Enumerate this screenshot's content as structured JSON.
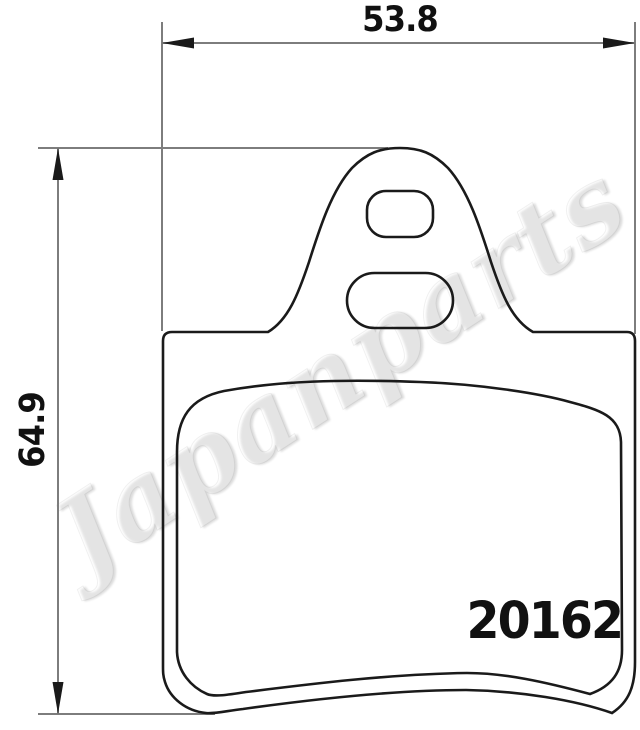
{
  "document": {
    "type": "technical-drawing",
    "subject": "brake-pad-outline"
  },
  "colors": {
    "background": "#ffffff",
    "outline": "#1a1a1a",
    "dimension": "#7d7d7d",
    "text": "#111111"
  },
  "dimensions": {
    "width": {
      "value": "53.8"
    },
    "height": {
      "value": "64.9"
    }
  },
  "part_number": "20162",
  "watermark": {
    "text": "Japanparts"
  }
}
